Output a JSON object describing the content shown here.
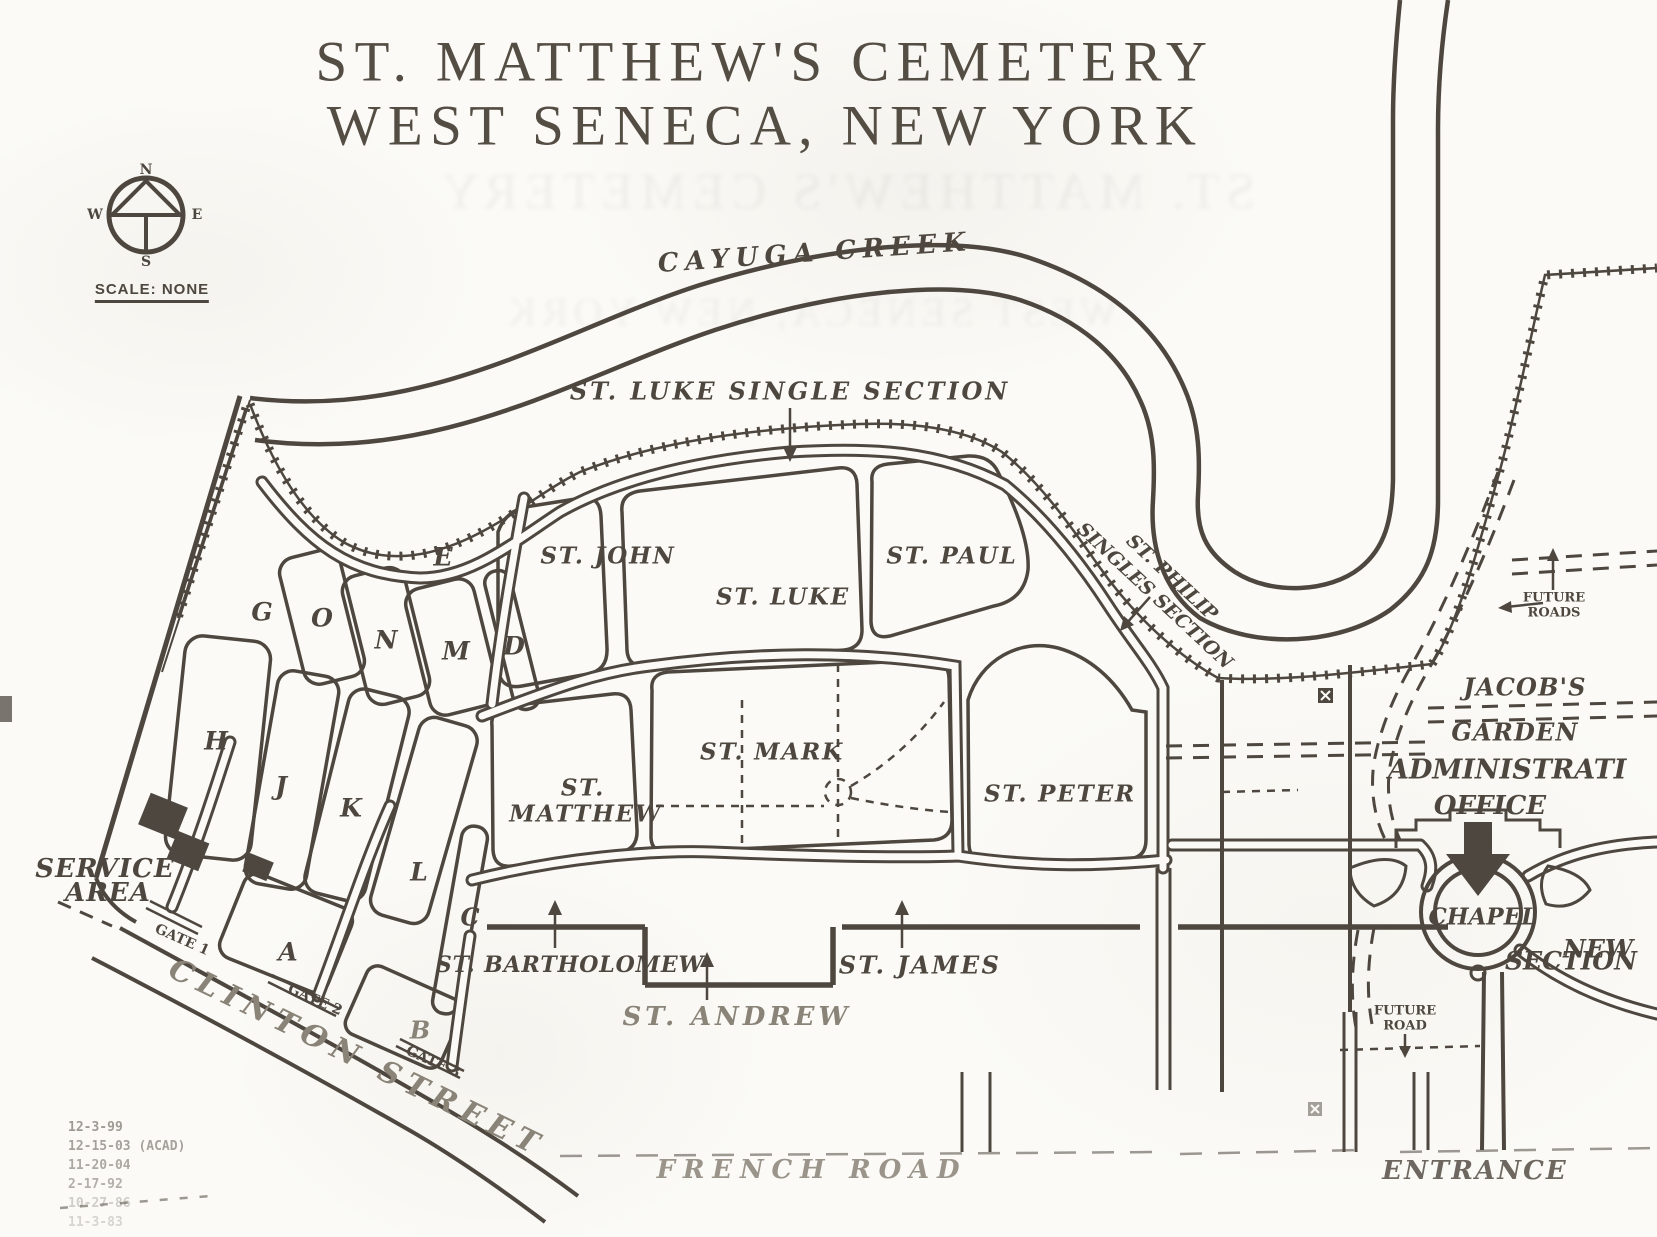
{
  "colors": {
    "ink": "#4e473f",
    "paper": "#fbfaf6",
    "faded": "#8a8378"
  },
  "title": {
    "line1": "ST. MATTHEW'S CEMETERY",
    "line2": "WEST SENECA, NEW YORK"
  },
  "compass": {
    "north": "N",
    "south": "S",
    "east": "E",
    "west": "W",
    "scale": "SCALE: NONE"
  },
  "creek": {
    "name": "CAYUGA CREEK"
  },
  "sections": {
    "st_luke_single": "ST. LUKE SINGLE SECTION",
    "st_john": "ST. JOHN",
    "st_luke": "ST. LUKE",
    "st_paul": "ST. PAUL",
    "st_philip": {
      "line1": "ST. PHILIP",
      "line2": "SINGLES SECTION"
    },
    "st_mark": "ST. MARK",
    "st_matthew": {
      "line1": "ST.",
      "line2": "MATTHEW"
    },
    "st_peter": "ST. PETER",
    "st_bartholomew": "ST. BARTHOLOMEW",
    "st_andrew": "ST. ANDREW",
    "st_james": "ST. JAMES",
    "letters": {
      "e": "E",
      "g": "G",
      "o": "O",
      "n": "N",
      "m": "M",
      "d": "D",
      "h": "H",
      "j": "J",
      "k": "K",
      "l": "L",
      "c": "C",
      "a": "A",
      "b": "B"
    }
  },
  "buildings": {
    "admin": {
      "line1": "ADMINISTRATI",
      "line2": "OFFICE"
    },
    "chapel": "CHAPEL",
    "jacobs": {
      "line1": "JACOB'S",
      "line2": "GARDEN"
    },
    "new_section": {
      "line1": "NEW",
      "line2": "SECTION"
    },
    "service": {
      "line1": "SERVICE",
      "line2": "AREA"
    }
  },
  "roads": {
    "clinton": "CLINTON STREET",
    "french": "FRENCH ROAD",
    "entrance": "ENTRANCE",
    "future_roads": {
      "line1": "FUTURE",
      "line2": "ROADS"
    },
    "future_road": {
      "line1": "FUTURE",
      "line2": "ROAD"
    }
  },
  "gates": {
    "gate1": "GATE 1",
    "gate2": "GATE 2",
    "gate3": "GATE 3"
  },
  "revisions": [
    "12-3-99",
    "12-15-03 (ACAD)",
    "11-20-04",
    "2-17-92",
    "10-27-86",
    "11-3-83"
  ]
}
